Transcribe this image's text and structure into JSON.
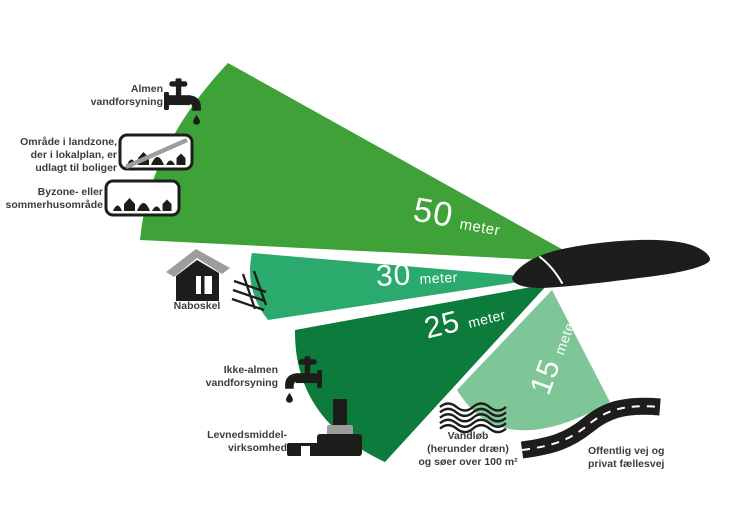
{
  "title": "Afstandskrav (sprøjtezoner) infografik",
  "palette": {
    "zone_50_color": "#3fa238",
    "zone_30_color": "#2baa6e",
    "zone_25_color": "#0c7b3b",
    "zone_15_color": "#7ec698",
    "icon_black": "#1d1d1b",
    "icon_gray": "#9d9d9c",
    "label_color": "#3c3c3b",
    "number_color": "#ffffff"
  },
  "zones": [
    {
      "value": "50",
      "unit": "meter",
      "color": "#3fa238"
    },
    {
      "value": "30",
      "unit": "meter",
      "color": "#2baa6e"
    },
    {
      "value": "25",
      "unit": "meter",
      "color": "#0c7b3b"
    },
    {
      "value": "15",
      "unit": "meter",
      "color": "#7ec698"
    }
  ],
  "features": [
    {
      "icon": "tap-icon",
      "label": "Almen\nvandforsyning"
    },
    {
      "icon": "no-urban-zone-sign-icon",
      "label": "Område i landzone,\nder i lokalplan, er\nudlagt til boliger"
    },
    {
      "icon": "urban-zone-sign-icon",
      "label": "Byzone- eller\nsommerhusområde"
    },
    {
      "icon": "house-icon",
      "label": "Naboskel"
    },
    {
      "icon": "tap-icon",
      "label": "Ikke-almen\nvandforsyning"
    },
    {
      "icon": "factory-icon",
      "label": "Levnedsmiddel-\nvirksomhed"
    },
    {
      "icon": "waves-icon",
      "label": "Vandløb\n(herunder dræn)\nog søer over 100 m²"
    },
    {
      "icon": "road-icon",
      "label": "Offentlig vej og\nprivat fællesvej"
    }
  ]
}
